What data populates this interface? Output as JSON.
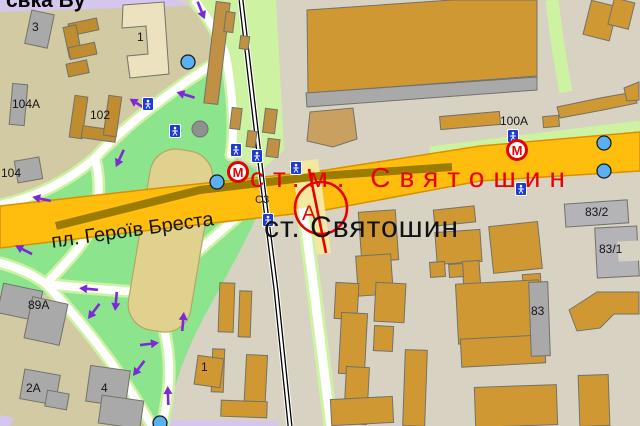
{
  "labels": {
    "street_top": "свка Ву",
    "square": "пл. Героїв Бреста",
    "metro_station": "ст.м. Святошин",
    "rail_station": "ст. Святошин",
    "road_ref": "С3"
  },
  "markers": {
    "metro_letter": "М",
    "stop_letter": "А"
  },
  "building_labels": [
    "3",
    "1",
    "104А",
    "102",
    "104",
    "89А",
    "2А",
    "4",
    "1",
    "100А",
    "83/2",
    "83/1",
    "83"
  ],
  "colors": {
    "road_main": "#FFBE0E",
    "road_border": "#D98F00",
    "road_median_olive": "#9B7B00",
    "park_green": "#8CE48C",
    "path_edge_green": "#CDF3A2",
    "background_khaki": "#D1CAA3",
    "background_beige": "#D8D2C2",
    "building_ochre": "#CF9833",
    "building_gray": "#A9A9A9",
    "building_cream": "#ECE2C0",
    "stadium_khaki": "#E0D18E",
    "metro_red": "#E60000",
    "station_label_red": "#EA0000",
    "arrow_purple": "#7D2AD6",
    "side_road_lavender": "#D5C6EE",
    "stop_dot_blue": "#59B1F1",
    "ped_sign_blue": "#1E3BD1"
  }
}
